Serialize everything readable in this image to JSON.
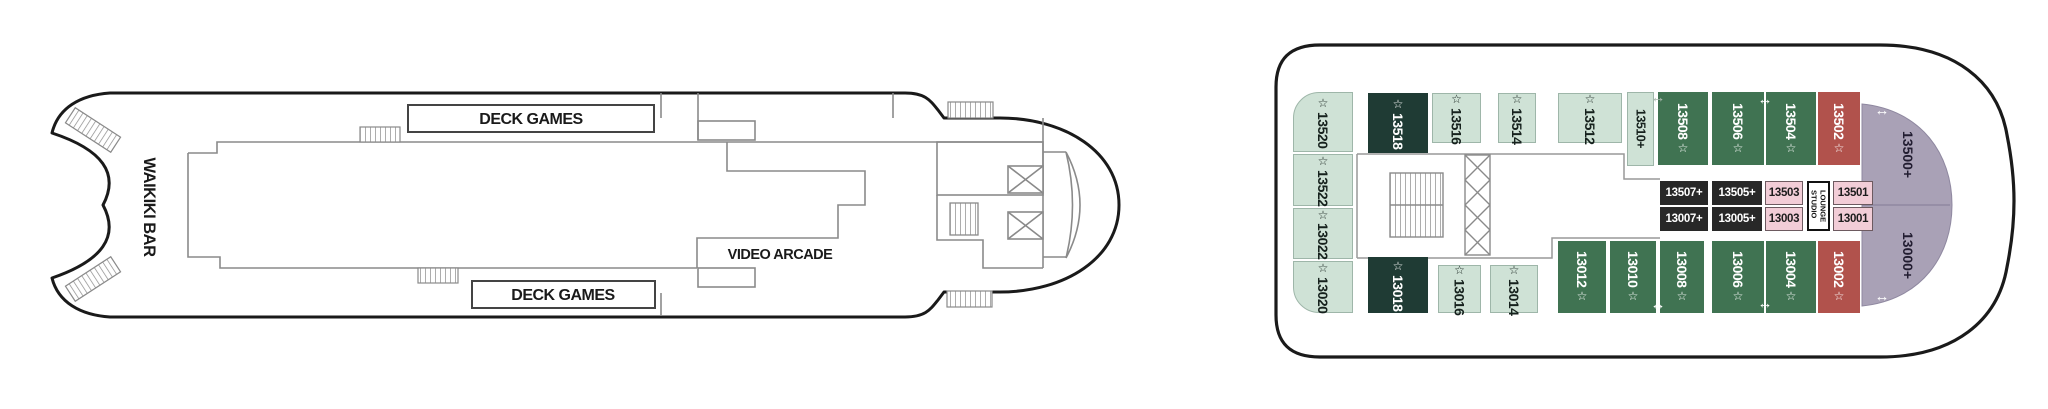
{
  "left_deck": {
    "labels": {
      "waikiki_bar": "WAIKIKI BAR",
      "deck_games_top": "DECK GAMES",
      "deck_games_bottom": "DECK GAMES",
      "video_arcade": "VIDEO ARCADE"
    }
  },
  "right_deck": {
    "port_column": [
      {
        "number": "13520"
      },
      {
        "number": "13522"
      },
      {
        "number": "13022"
      },
      {
        "number": "13020"
      }
    ],
    "top_row": [
      {
        "number": "13518"
      },
      {
        "number": "13516"
      },
      {
        "number": "13514"
      },
      {
        "number": "13512"
      },
      {
        "number": "13510+"
      },
      {
        "number": "13508"
      },
      {
        "number": "13506"
      },
      {
        "number": "13504"
      },
      {
        "number": "13502"
      }
    ],
    "bottom_row": [
      {
        "number": "13018"
      },
      {
        "number": "13016"
      },
      {
        "number": "13014"
      },
      {
        "number": "13012"
      },
      {
        "number": "13010"
      },
      {
        "number": "13008"
      },
      {
        "number": "13006"
      },
      {
        "number": "13004"
      },
      {
        "number": "13002"
      }
    ],
    "studio_row_top": [
      {
        "number": "13507+"
      },
      {
        "number": "13505+"
      },
      {
        "number": "13503"
      },
      {
        "number": "13501"
      }
    ],
    "studio_row_bottom": [
      {
        "number": "13007+"
      },
      {
        "number": "13005+"
      },
      {
        "number": "13003"
      },
      {
        "number": "13001"
      }
    ],
    "studio_lounge": {
      "line1": "STUDIO",
      "line2": "LOUNGE"
    },
    "bow_cabins": [
      {
        "number": "13500+"
      },
      {
        "number": "13000+"
      }
    ]
  },
  "icons": {
    "star": "☆",
    "arrow": "↔"
  },
  "colors": {
    "mint": "#cfe2d6",
    "dark_teal": "#1f3b34",
    "green": "#407352",
    "red": "#b1524c",
    "purple": "#a9a1b6",
    "pink": "#f2cdd7",
    "studio_black": "#282828",
    "hull_line": "#1a1a1a",
    "interior_line": "#8a8a8a"
  }
}
